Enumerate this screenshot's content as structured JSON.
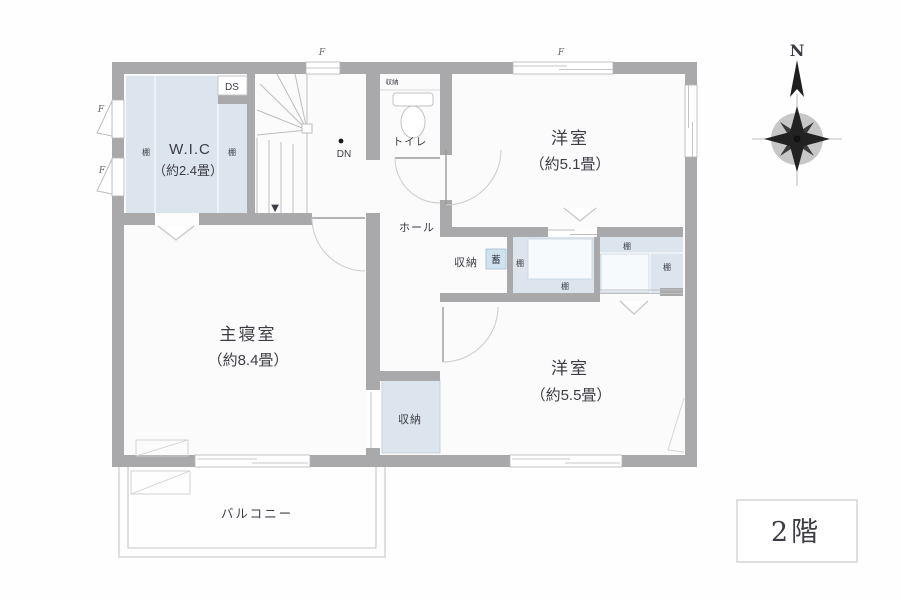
{
  "plan": {
    "floor_badge": "2階",
    "compass_north": "N",
    "rooms": {
      "wic": {
        "name": "W.I.C",
        "size": "（約2.4畳）"
      },
      "master": {
        "name": "主寝室",
        "size": "（約8.4畳）"
      },
      "west1": {
        "name": "洋室",
        "size": "（約5.1畳）"
      },
      "west2": {
        "name": "洋室",
        "size": "（約5.5畳）"
      },
      "toilet": "トイレ",
      "hall": "ホール",
      "balcony": "バルコニー"
    },
    "labels": {
      "storage": "収納",
      "shelf": "棚",
      "ds": "DS",
      "dn": "DN",
      "fix": "F",
      "battery": "蓄",
      "down_marker": "▼"
    },
    "colors": {
      "wall": "#a9a9ab",
      "closet_fill": "#dce5ed",
      "thin_line": "#bfbfbf",
      "text": "#3c3c45",
      "battery_box_fill": "#cfe2ef",
      "battery_box_border": "#a9c4d8"
    }
  }
}
